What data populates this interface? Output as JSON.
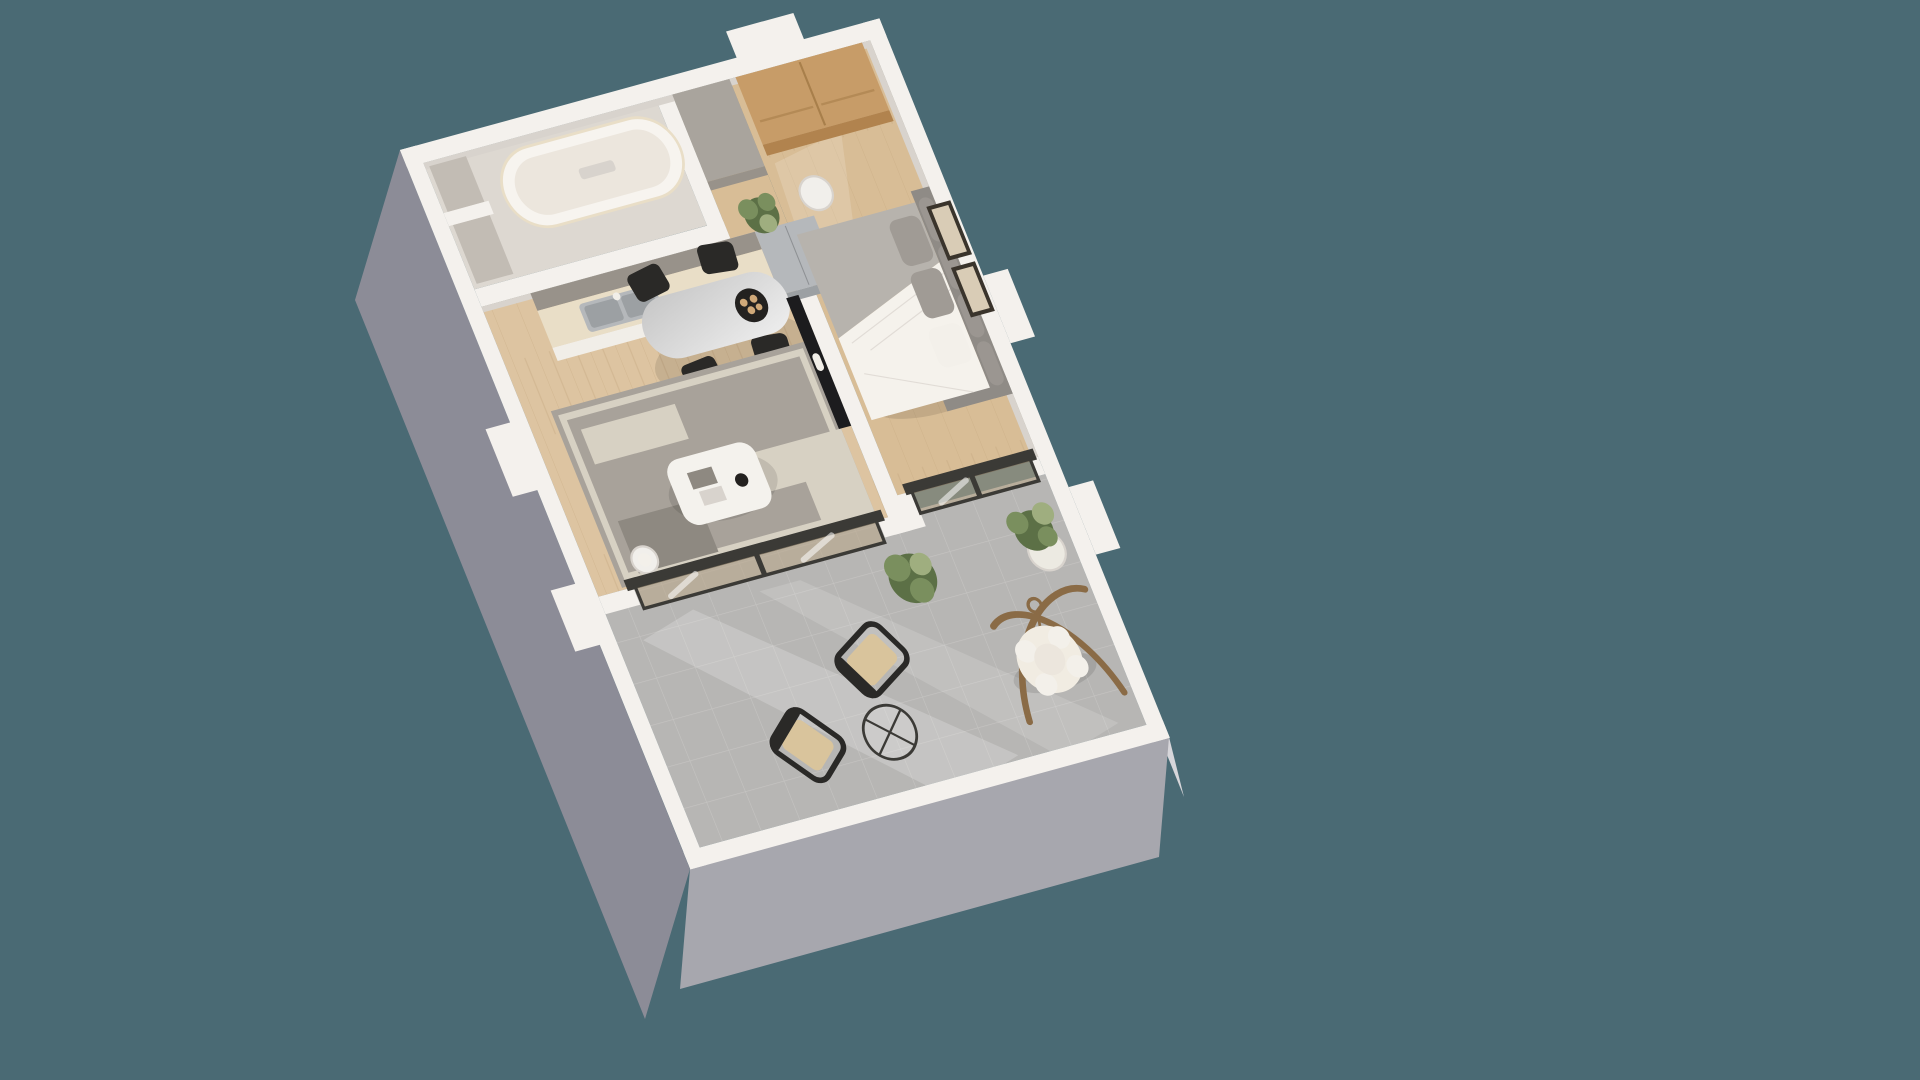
{
  "scene": {
    "label": "Isometric 3D floor plan render of a one-bedroom apartment with balcony terrace",
    "type": "3d-floorplan-render",
    "rooms": [
      {
        "name": "bathroom",
        "features": [
          "bathtub",
          "storage-niches",
          "marble-walls"
        ]
      },
      {
        "name": "kitchen",
        "features": [
          "double-basin-sink",
          "faucet",
          "countertop",
          "white-cabinets",
          "stainless-fridge",
          "potted-plant"
        ]
      },
      {
        "name": "living-dining",
        "features": [
          "oval-marble-dining-table",
          "four-black-chairs",
          "plate-of-pastries",
          "gray-patterned-rug",
          "white-coffee-table",
          "wall-tv",
          "pedestal-side-table",
          "sliding-glass-door"
        ]
      },
      {
        "name": "bedroom",
        "features": [
          "double-bed",
          "gray-tufted-headboard",
          "oak-wardrobe",
          "round-side-table",
          "two-framed-artworks",
          "sliding-glass-door"
        ]
      },
      {
        "name": "balcony-terrace",
        "features": [
          "hanging-egg-chair",
          "wooden-arc-stand",
          "plant-in-white-pot",
          "green-bush",
          "two-cane-lounge-chairs",
          "wire-coffee-table",
          "concrete-pavers"
        ]
      }
    ]
  },
  "colors": {
    "bg": "#4a6a74",
    "wallTop": "#f4f1ed",
    "wallShade": "#d8d3cd",
    "leftFace": "#8c8c97",
    "bottomFace": "#a7a7ae",
    "rightFace": "#d7d6da",
    "bathFloor": "#ddd8d1",
    "nicheFill": "#c2bcb4",
    "tubRim": "#f7f4ef",
    "tubInner": "#ece6dd",
    "columnGray": "#a9a49d",
    "woodLiving": "#ddc4a1",
    "woodBedroom": "#d8bd96",
    "woodLine": "#c2a57e",
    "concrete": "#b7b6b4",
    "concreteLine": "#c9c8c6",
    "backsplash": "#98928a",
    "counterTop": "#e9dec7",
    "cabinetFace": "#f1eee8",
    "stainless": "#b5b8bb",
    "stainlessDark": "#9ca0a3",
    "wardrobeWood": "#c79c68",
    "wardrobeFace": "#b1834e",
    "woodSeam": "#a87f4b",
    "tableTop": "#c9c9c9",
    "tableTopLight": "#ececec",
    "chairBlack": "#2a2927",
    "plateBlack": "#23211f",
    "breadBeige": "#cfa878",
    "rugBase": "#a8a29a",
    "rugCream": "#d7d1c3",
    "rugDark": "#8e8981",
    "coffeeTable": "#f4f2ed",
    "tvBlack": "#1c1c1e",
    "bedWhite": "#f5f2ec",
    "bedGray": "#b7b3ad",
    "pillowGray": "#a09b95",
    "pillowWhite": "#f3f0ea",
    "headboard": "#8f8b86",
    "cushion": "#9b9691",
    "sideTable": "#f1efeb",
    "frameDark": "#3a342c",
    "frameArt": "#d9ccb6",
    "doorFrame": "#3b3a36",
    "glassTint": "rgba(186,166,134,0.55)",
    "glassStreak": "#ffffff",
    "plantGreen": "#7a8f5e",
    "plantDark": "#5c7046",
    "plantLight": "#9fae7f",
    "potWhite": "#eceae2",
    "eggCushion": "#f1ece2",
    "eggStand": "#8a6b46",
    "caneSeat": "#d9c49c",
    "sunlight": "#ffffff"
  }
}
